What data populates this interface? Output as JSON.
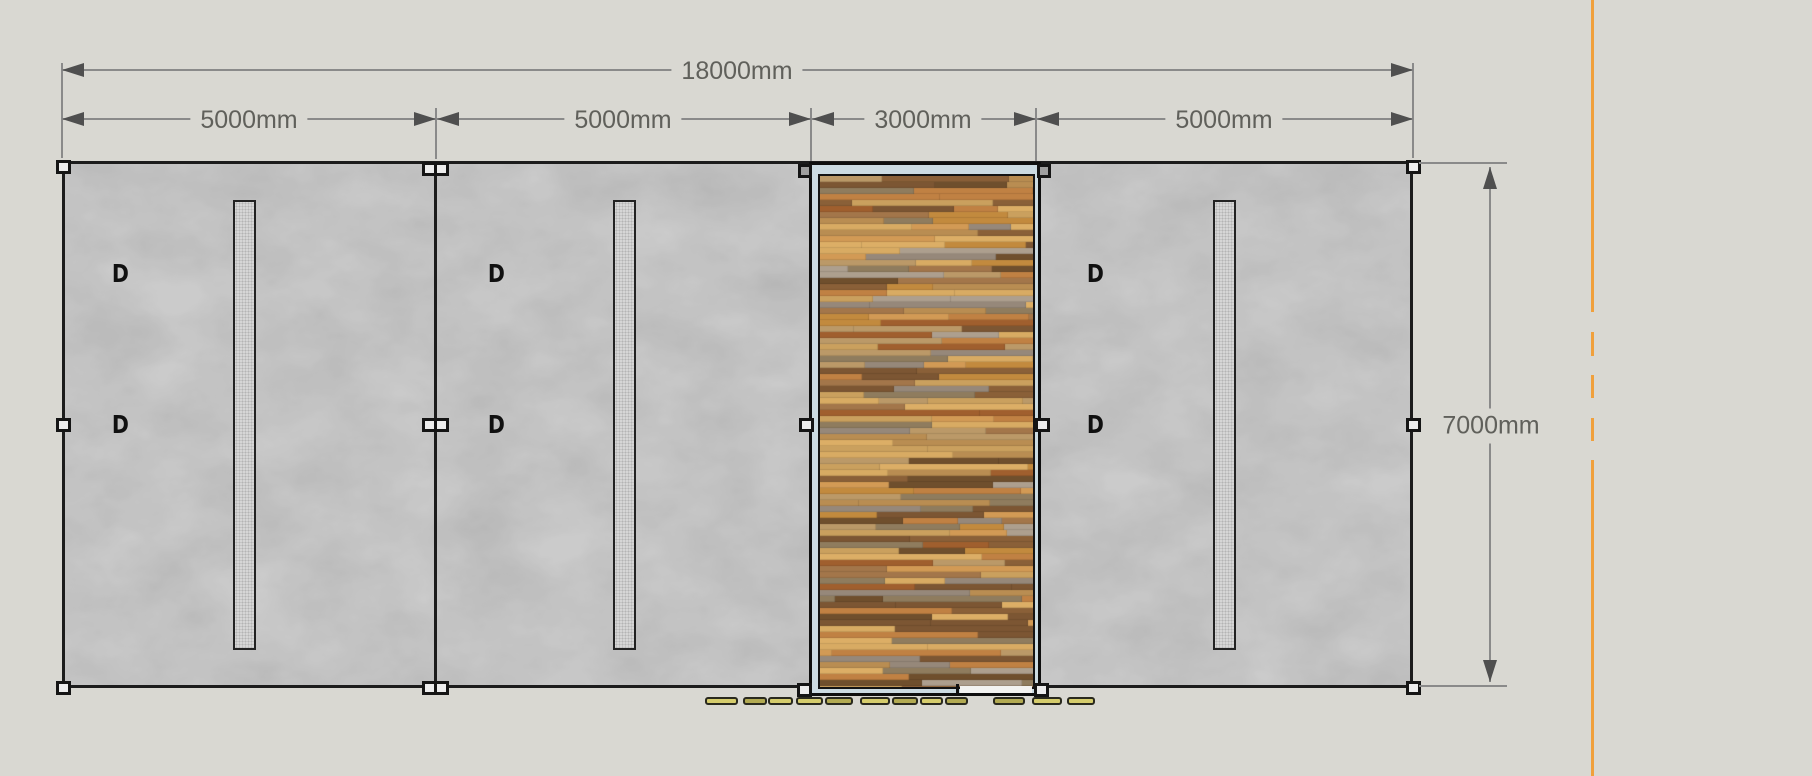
{
  "drawing": {
    "description": "Wall elevation with dimensions",
    "dim_total_width": "18000mm",
    "dim_segments": [
      "5000mm",
      "5000mm",
      "3000mm",
      "5000mm"
    ],
    "dim_height": "7000mm",
    "door_label": "D"
  },
  "colors": {
    "bg": "#d9d8d2",
    "wall_fill": "#cbcbcb",
    "line_dark": "#1c1c1c",
    "dim_line": "#8a8a8a",
    "dim_text": "#60605b",
    "arrow": "#4f4f4f",
    "panel_frame": "#ccdbe2",
    "strip_fill": "#d6d6d6",
    "post_gray": "#9f9f9f",
    "axis_orange": "#f0a03c",
    "yellow_a": "#d6cd6d",
    "yellow_b": "#b2aa52"
  },
  "wood_palette": [
    "#c08143",
    "#d29a55",
    "#8a6038",
    "#a3764a",
    "#b98d52",
    "#96887a",
    "#ad9f8e",
    "#7c5633",
    "#caa05e",
    "#dcae66",
    "#8f7c5e",
    "#c28a3e",
    "#a05f2e",
    "#bb9968",
    "#6f4f2d",
    "#d8ab63"
  ],
  "yellow_segments": [
    {
      "x": 705,
      "w": 33,
      "tone": "a"
    },
    {
      "x": 743,
      "w": 24,
      "tone": "b"
    },
    {
      "x": 768,
      "w": 25,
      "tone": "a"
    },
    {
      "x": 796,
      "w": 27,
      "tone": "a"
    },
    {
      "x": 825,
      "w": 28,
      "tone": "b"
    },
    {
      "x": 860,
      "w": 30,
      "tone": "a"
    },
    {
      "x": 892,
      "w": 26,
      "tone": "b"
    },
    {
      "x": 920,
      "w": 23,
      "tone": "a"
    },
    {
      "x": 945,
      "w": 23,
      "tone": "b"
    },
    {
      "x": 993,
      "w": 32,
      "tone": "b"
    },
    {
      "x": 1032,
      "w": 30,
      "tone": "a"
    },
    {
      "x": 1067,
      "w": 28,
      "tone": "a"
    }
  ],
  "axis": {
    "solid_top": [
      0,
      312
    ],
    "dashes": [
      [
        332,
        24
      ],
      [
        375,
        23
      ],
      [
        418,
        23
      ]
    ],
    "solid_bottom": [
      460,
      316
    ]
  }
}
